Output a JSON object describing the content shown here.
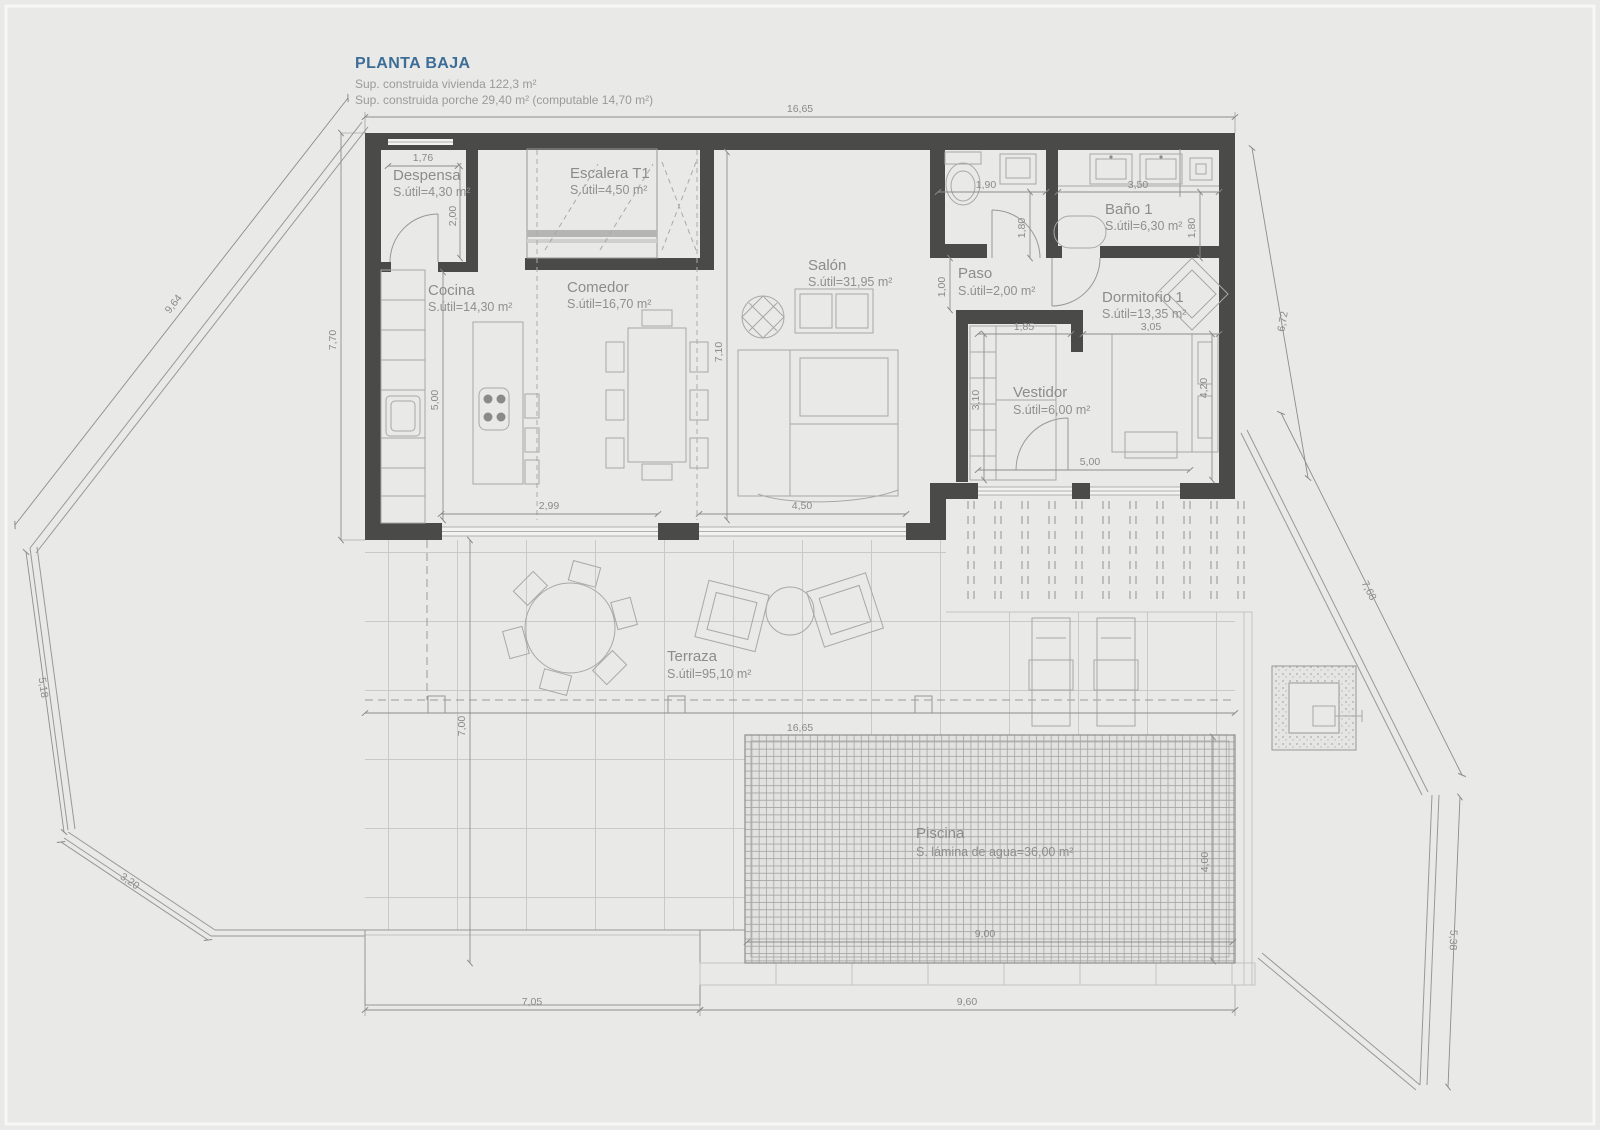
{
  "header": {
    "title": "PLANTA BAJA",
    "line1": "Sup. construida vivienda 122,3 m²",
    "line2": "Sup. construida porche 29,40 m² (computable 14,70 m²)"
  },
  "rooms": {
    "despensa": {
      "name": "Despensa",
      "area": "S.útil=4,30 m²"
    },
    "escalera": {
      "name": "Escalera T1",
      "area": "S.útil=4,50 m²"
    },
    "cocina": {
      "name": "Cocina",
      "area": "S.útil=14,30 m²"
    },
    "comedor": {
      "name": "Comedor",
      "area": "S.útil=16,70 m²"
    },
    "salon": {
      "name": "Salón",
      "area": "S.útil=31,95 m²"
    },
    "paso": {
      "name": "Paso",
      "area": "S.útil=2,00 m²"
    },
    "bano1": {
      "name": "Baño 1",
      "area": "S.útil=6,30 m²"
    },
    "dormitorio1": {
      "name": "Dormitorio 1",
      "area": "S.útil=13,35 m²"
    },
    "vestidor": {
      "name": "Vestidor",
      "area": "S.útil=6,00 m²"
    },
    "terraza": {
      "name": "Terraza",
      "area": "S.útil=95,10 m²"
    },
    "piscina": {
      "name": "Piscina",
      "area": "S. lámina de agua=36,00 m²"
    }
  },
  "dims": {
    "top_width": "16,65",
    "despensa_w": "1,76",
    "despensa_h": "2,00",
    "left_h": "7,70",
    "cocina_h": "5,00",
    "salon_h": "7,10",
    "window_comedor": "2,99",
    "window_salon": "4,50",
    "wc_w": "1,90",
    "wc_h": "1,80",
    "bano_w": "3,50",
    "bano_h": "1,80",
    "paso_h": "1,00",
    "vestidor_top": "1,85",
    "dorm_w": "3,05",
    "vestidor_h": "3,10",
    "dorm_h": "4,20",
    "porch_door": "5,00",
    "right_h": "6,72",
    "terraza_w": "16,65",
    "terraza_h": "7,00",
    "pool_w": "9,00",
    "pool_h": "4,00",
    "bottom_left": "7,05",
    "bottom_right": "9,60",
    "plot_nw": "9,64",
    "plot_w": "5,18",
    "plot_sw": "3,20",
    "plot_ne": "7,68",
    "plot_se": "5,38"
  },
  "colors": {
    "accent": "#3c6d96",
    "wall": "#4a4a49",
    "background": "#e9e9e7",
    "line": "#989896",
    "text": "#8c8c8a"
  }
}
